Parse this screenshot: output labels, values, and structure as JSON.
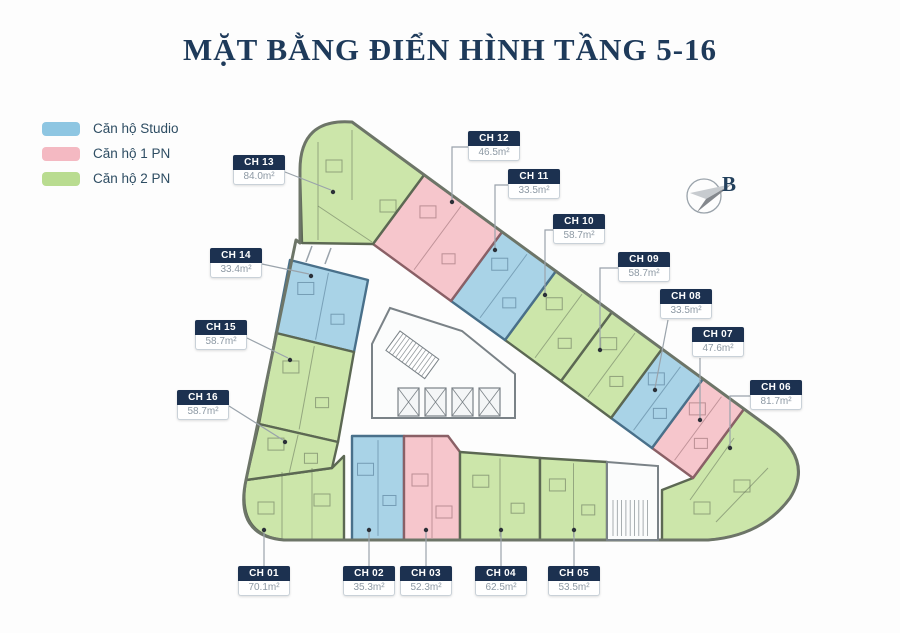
{
  "title": "MẶT BẰNG ĐIỂN HÌNH TẦNG 5-16",
  "legend": {
    "items": [
      {
        "label": "Căn hộ Studio",
        "type": "studio"
      },
      {
        "label": "Căn hộ 1 PN",
        "type": "pn1"
      },
      {
        "label": "Căn hộ 2 PN",
        "type": "pn2"
      }
    ]
  },
  "compass": {
    "label": "B"
  },
  "units": [
    {
      "id": "CH 01",
      "area": "70.1m²",
      "type": "pn2"
    },
    {
      "id": "CH 02",
      "area": "35.3m²",
      "type": "studio"
    },
    {
      "id": "CH 03",
      "area": "52.3m²",
      "type": "pn1"
    },
    {
      "id": "CH 04",
      "area": "62.5m²",
      "type": "pn2"
    },
    {
      "id": "CH 05",
      "area": "53.5m²",
      "type": "pn2"
    },
    {
      "id": "CH 06",
      "area": "81.7m²",
      "type": "pn2"
    },
    {
      "id": "CH 07",
      "area": "47.6m²",
      "type": "pn1"
    },
    {
      "id": "CH 08",
      "area": "33.5m²",
      "type": "studio"
    },
    {
      "id": "CH 09",
      "area": "58.7m²",
      "type": "pn2"
    },
    {
      "id": "CH 10",
      "area": "58.7m²",
      "type": "pn2"
    },
    {
      "id": "CH 11",
      "area": "33.5m²",
      "type": "studio"
    },
    {
      "id": "CH 12",
      "area": "46.5m²",
      "type": "pn1"
    },
    {
      "id": "CH 13",
      "area": "84.0m²",
      "type": "pn2"
    },
    {
      "id": "CH 14",
      "area": "33.4m²",
      "type": "studio"
    },
    {
      "id": "CH 15",
      "area": "58.7m²",
      "type": "pn2"
    },
    {
      "id": "CH 16",
      "area": "58.7m²",
      "type": "pn2"
    }
  ],
  "colors": {
    "title": "#1e3a5a",
    "legend_text": "#2e4d63",
    "label_header_bg": "#1c3150",
    "label_header_text": "#ffffff",
    "label_area_text": "#8d99a4",
    "label_border": "#c9d1d8",
    "building_outline": "#6d7568",
    "core_stroke": "#7a8287",
    "core_fill": "#fbfcfc",
    "leader": "#9aa3ab",
    "dot": "#2b3038",
    "fills": {
      "studio": "#a9d3e7",
      "pn1": "#f6c6cc",
      "pn2": "#cce6aa"
    },
    "strokes": {
      "studio": "#49708a",
      "pn1": "#8a6066",
      "pn2": "#5c6853"
    },
    "legend_swatches": {
      "studio": "#8ec6e2",
      "pn1": "#f4b9c2",
      "pn2": "#b9dc90"
    },
    "compass": {
      "ring": "#9aa3ab",
      "dark": "#84888d",
      "light": "#c7cbcf",
      "letter": "#23405c"
    }
  }
}
